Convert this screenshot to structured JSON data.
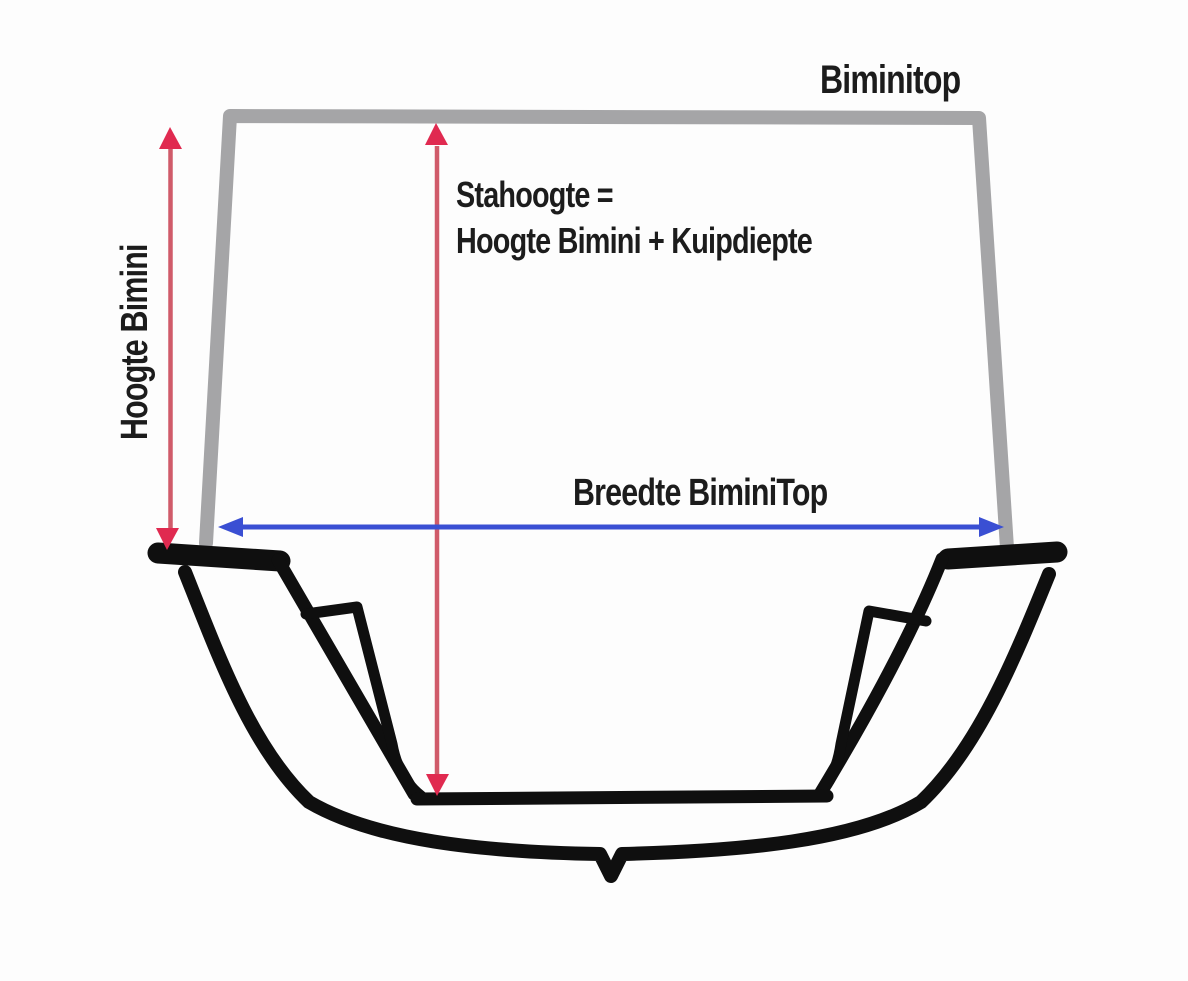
{
  "diagram": {
    "title_label": "Biminitop",
    "formula_line1": "Stahoogte =",
    "formula_line2": "Hoogte Bimini + Kuipdiepte",
    "height_label": "Hoogte Bimini",
    "width_label": "Breedte BiminiTop"
  },
  "colors": {
    "background": "#fdfdfd",
    "frame_gray": "#a5a5a7",
    "hull_black": "#0f0f0f",
    "text_black": "#1c1c1c",
    "arrow_red_head": "#e02a50",
    "arrow_red_shaft": "#d05b6a",
    "arrow_blue": "#3a4fd3",
    "none": "none"
  }
}
